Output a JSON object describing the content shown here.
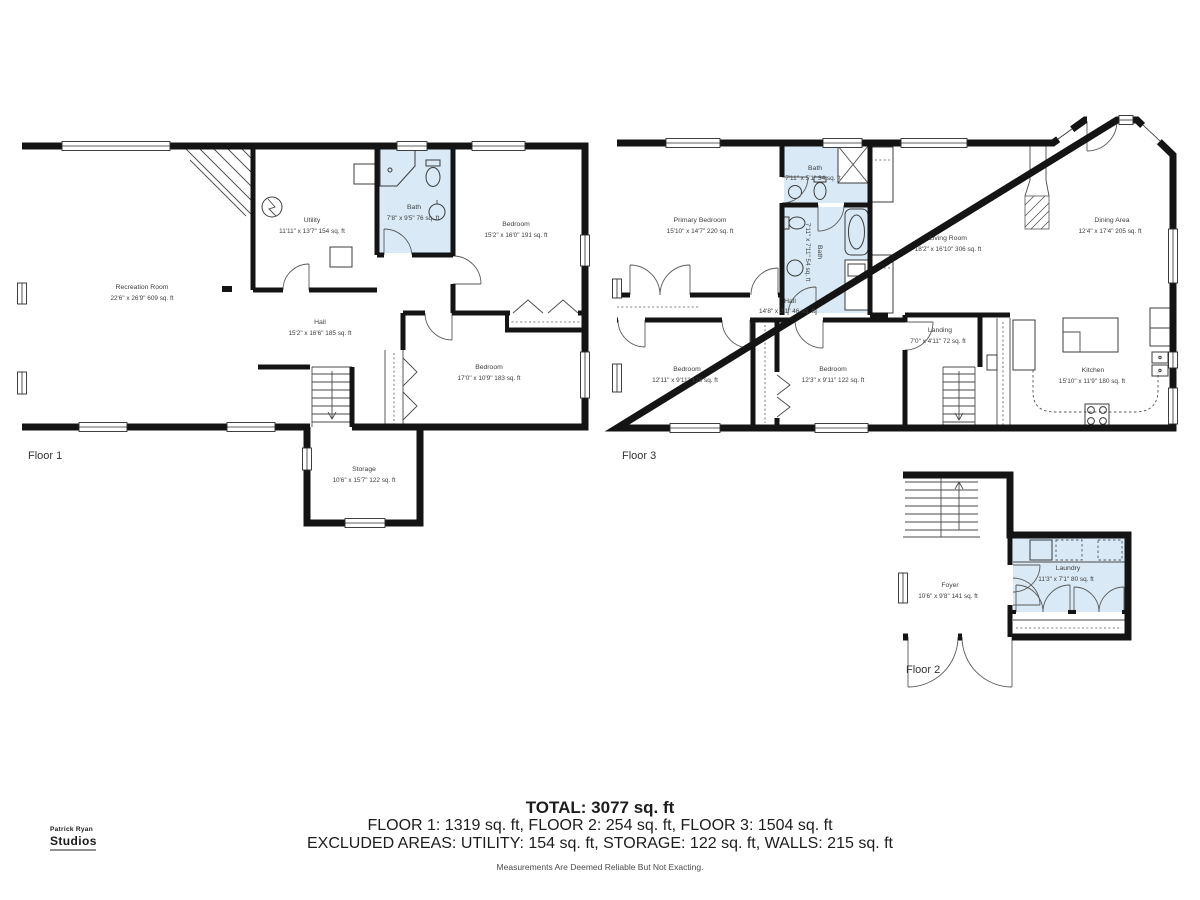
{
  "colors": {
    "wall": "#141414",
    "bath_fill": "#d9eaf6",
    "line": "#4a4a4a",
    "label_text": "#3e3e3e"
  },
  "floor1": {
    "label": "Floor 1",
    "rooms": {
      "recreation": {
        "name": "Recreation Room",
        "dims": "22'6\" x 26'9\" 609 sq. ft"
      },
      "utility": {
        "name": "Utility",
        "dims": "11'11\" x 13'7\" 154 sq. ft"
      },
      "bath": {
        "name": "Bath",
        "dims": "7'8\" x 9'5\" 76 sq. ft"
      },
      "bedroom1": {
        "name": "Bedroom",
        "dims": "15'2\" x 16'0\" 191 sq. ft"
      },
      "hall": {
        "name": "Hall",
        "dims": "15'2\" x 16'6\" 185 sq. ft"
      },
      "bedroom2": {
        "name": "Bedroom",
        "dims": "17'0\" x 10'9\" 183 sq. ft"
      },
      "storage": {
        "name": "Storage",
        "dims": "10'6\" x 15'7\" 122 sq. ft"
      }
    }
  },
  "floor3": {
    "label": "Floor 3",
    "rooms": {
      "primary": {
        "name": "Primary Bedroom",
        "dims": "15'10\" x 14'7\" 220 sq. ft"
      },
      "bath1": {
        "name": "Bath",
        "dims": "7'11\" x 5'1\" 34 sq. ft"
      },
      "bath2": {
        "name": "Bath",
        "dims": "7'11\" x 7'11\" 54 sq. ft"
      },
      "living": {
        "name": "Living Room",
        "dims": "18'2\" x 16'10\" 306 sq. ft"
      },
      "dining": {
        "name": "Dining Area",
        "dims": "12'4\" x 17'4\" 205 sq. ft"
      },
      "hall": {
        "name": "Hall",
        "dims": "14'8\" x 3'1\" 46 sq. ft"
      },
      "bedroom1": {
        "name": "Bedroom",
        "dims": "12'11\" x 9'11\" 128 sq. ft"
      },
      "bedroom2": {
        "name": "Bedroom",
        "dims": "12'3\" x 9'11\" 122 sq. ft"
      },
      "landing": {
        "name": "Landing",
        "dims": "7'0\" x 4'11\" 72 sq. ft"
      },
      "kitchen": {
        "name": "Kitchen",
        "dims": "15'10\" x 11'9\" 180 sq. ft"
      }
    }
  },
  "floor2": {
    "label": "Floor 2",
    "rooms": {
      "foyer": {
        "name": "Foyer",
        "dims": "10'6\" x 9'8\" 141 sq. ft"
      },
      "laundry": {
        "name": "Laundry",
        "dims": "11'3\" x 7'1\" 80 sq. ft"
      }
    }
  },
  "summary": {
    "total": "TOTAL: 3077 sq. ft",
    "floors": "FLOOR 1: 1319 sq. ft, FLOOR 2: 254 sq. ft, FLOOR 3: 1504 sq. ft",
    "excluded": "EXCLUDED AREAS: UTILITY: 154 sq. ft, STORAGE: 122 sq. ft, WALLS: 215 sq. ft",
    "disclaimer": "Measurements Are Deemed Reliable But Not Exacting."
  },
  "logo": {
    "line1": "Patrick Ryan",
    "line2": "Studios"
  }
}
